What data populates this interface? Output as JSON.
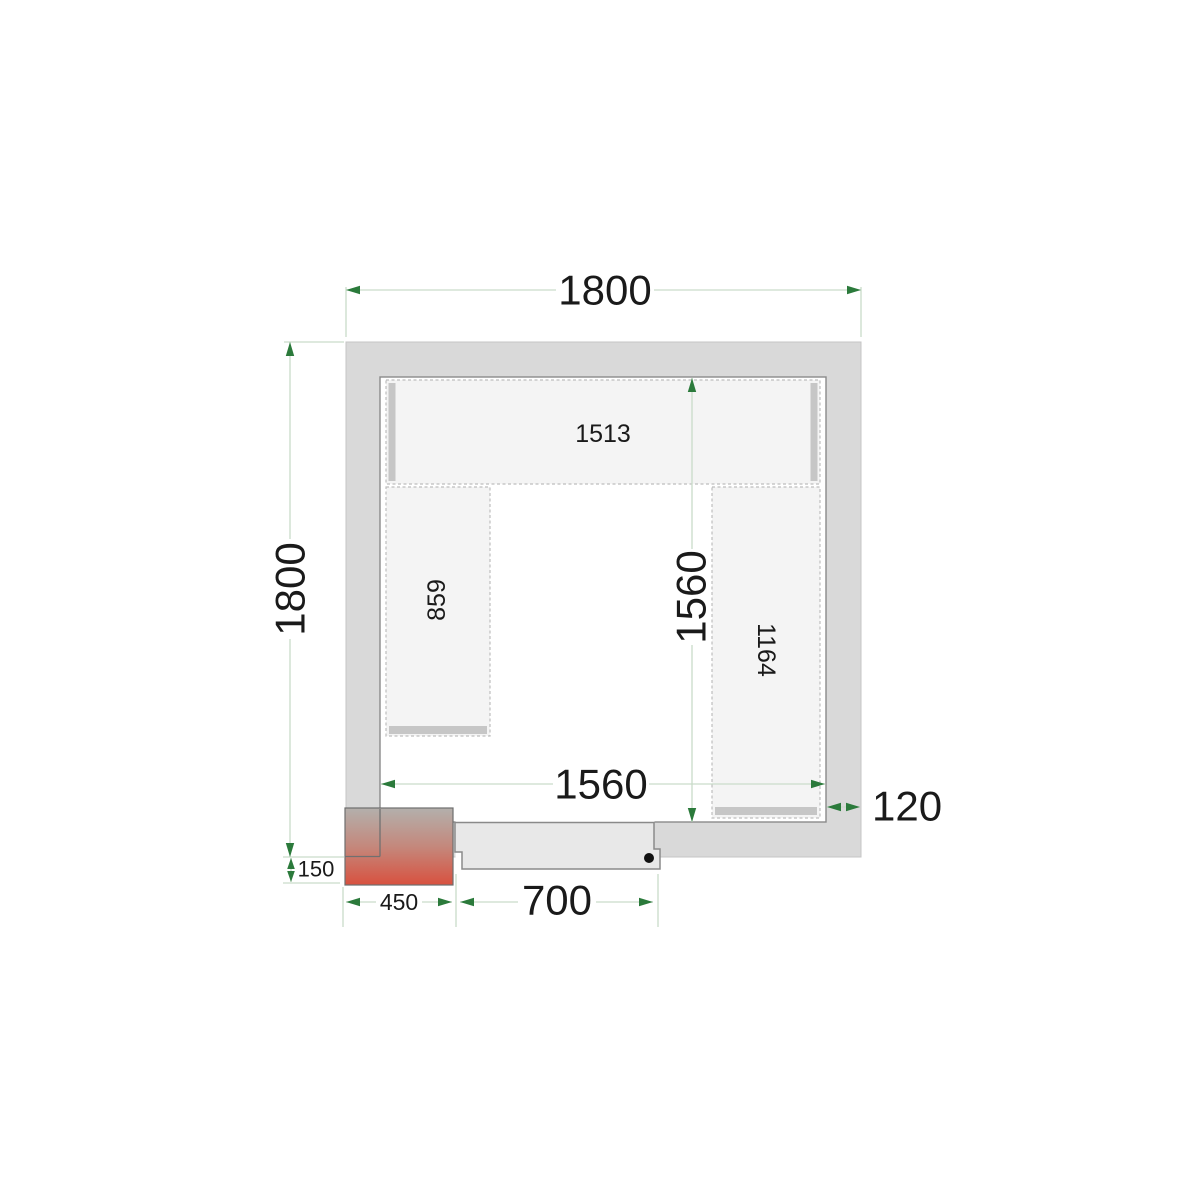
{
  "drawing": {
    "type": "cold-room-floor-plan-top-view",
    "labels": {
      "outer_width": "1800",
      "outer_depth": "1800",
      "inner_width": "1560",
      "inner_depth": "1560",
      "wall_thickness": "120",
      "door_opening": "700",
      "unit_width": "450",
      "unit_protrusion": "150"
    },
    "shelves": {
      "top": "1513",
      "left": "859",
      "right": "1164"
    },
    "colors": {
      "wall_fill": "#d9d9d9",
      "inner_outline": "#8a8a8a",
      "shelf_fill": "#f4f4f4",
      "shelf_dash_border": "#bdbdbd",
      "shelf_edge_strip": "#c6c6c6",
      "door_fill": "#e8e8e8",
      "door_outline": "#8a8a8a",
      "dimension_line": "#c9dcc9",
      "dimension_arrow": "#2b7a3b",
      "dimension_text": "#1a1a1a",
      "unit_gradient_top": "#b3b0ac",
      "unit_gradient_bottom": "#d8513f",
      "door_handle_dot": "#111111"
    }
  }
}
